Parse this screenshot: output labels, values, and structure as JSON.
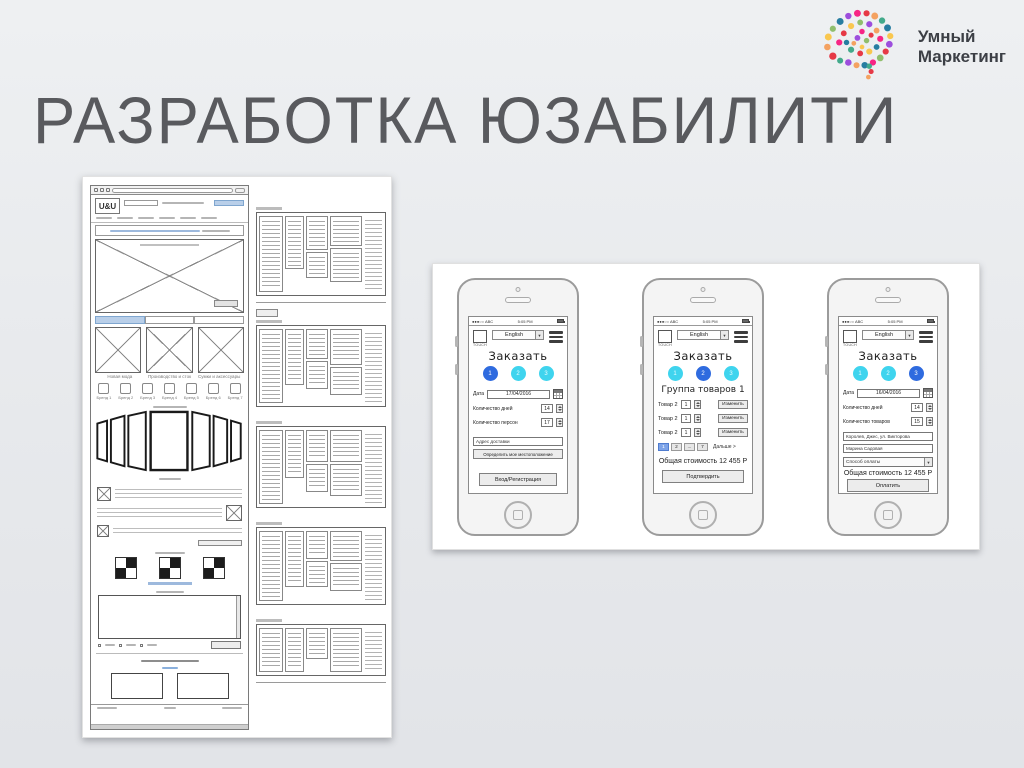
{
  "slide": {
    "title": "РАЗРАБОТКА ЮЗАБИЛИТИ"
  },
  "brand": {
    "line1": "Умный",
    "line2": "Маркетинг"
  },
  "colors": {
    "accent_cyan": "#3fd4ee",
    "accent_blue": "#2f6bdf",
    "title_gray": "#595a5e",
    "link_blue": "#5b9bd5"
  },
  "wireframe": {
    "site_logo": "U&U",
    "image_captions": [
      "Новая мода",
      "Производство и сток",
      "Сумки и аксессуары"
    ],
    "brand_items": [
      "Бренд 1",
      "Бренд 2",
      "Бренд 3",
      "Бренд 4",
      "Бренд 5",
      "Бренд 6",
      "Бренд 7"
    ]
  },
  "phones": [
    {
      "status": {
        "signal": "●●●○○ ABC",
        "time": "5:05 PM"
      },
      "header": {
        "logo": "TOUCH",
        "language": "English",
        "arrow": "▼"
      },
      "title": "Заказать",
      "steps": [
        "1",
        "2",
        "3"
      ],
      "active_step": 1,
      "fields": [
        {
          "label": "Дата",
          "value": "17/04/2016"
        },
        {
          "label": "Количество дней",
          "value": "14"
        },
        {
          "label": "Количество персон",
          "value": "17"
        }
      ],
      "address_placeholder": "Адрес доставки",
      "locate_button": "Определить мое местоположение",
      "auth_button": "Вход/Регистрация"
    },
    {
      "status": {
        "signal": "●●●○○ ABC",
        "time": "5:05 PM"
      },
      "header": {
        "logo": "TOUCH",
        "language": "English",
        "arrow": "▼"
      },
      "title": "Заказать",
      "steps": [
        "1",
        "2",
        "3"
      ],
      "active_step": 2,
      "group_title": "Группа товаров 1",
      "items": [
        {
          "label": "Товар 2",
          "qty": "1",
          "action": "Изменить"
        },
        {
          "label": "Товар 2",
          "qty": "1",
          "action": "Изменить"
        },
        {
          "label": "Товар 2",
          "qty": "1",
          "action": "Изменить"
        }
      ],
      "pagination": {
        "pages": [
          "1",
          "2",
          "...",
          "7"
        ],
        "next": "Дальше >"
      },
      "total": "Общая стоимость 12 455 Р",
      "confirm_button": "Подтвердить"
    },
    {
      "status": {
        "signal": "●●●○○ ABC",
        "time": "5:05 PM"
      },
      "header": {
        "logo": "TOUCH",
        "language": "English",
        "arrow": "▼"
      },
      "title": "Заказать",
      "steps": [
        "1",
        "2",
        "3"
      ],
      "active_step": 3,
      "fields": [
        {
          "label": "Дата",
          "value": "16/04/2016"
        },
        {
          "label": "Количество дней",
          "value": "14"
        },
        {
          "label": "Количество товаров",
          "value": "15"
        }
      ],
      "address_value": "Королев, Джес, ул. Викторова",
      "name_value": "Марина Садовая",
      "payment_select": "Способ оплаты",
      "total": "Общая стоимость 12 455 Р",
      "pay_button": "Оплатить"
    }
  ]
}
